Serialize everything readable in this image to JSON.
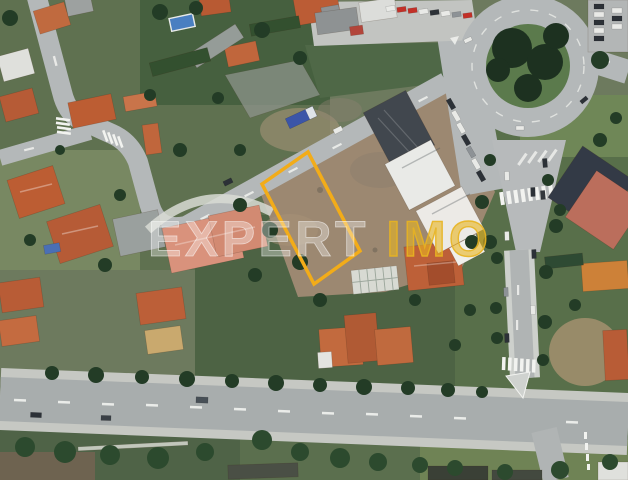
{
  "watermark": {
    "text": "EXPERTIMO",
    "text_primary": "EXPERT",
    "text_accent": "IMO",
    "primary_color": "#ffffff",
    "accent_color": "#e8b421"
  },
  "plot_highlight": {
    "points": "308,152 360,251 314,284 262,184",
    "stroke_color": "#f2ac19",
    "stroke_width": "3.5"
  },
  "palette": {
    "road": "#b4b8b9",
    "avenue_asphalt": "#a8adad",
    "sidewalk": "#c6c8c3",
    "dirt_lot": "#9c8871",
    "grass_dark": "#4d6344",
    "grass_mid": "#5f7150",
    "grass_light": "#72865a",
    "tree_dark": "#233c26",
    "roof_orange": "#c0653c",
    "roof_salmon": "#d9927c",
    "roof_dark_navy": "#333a46",
    "building_white": "#e9eae7",
    "building_dark": "#41474e",
    "marking_white": "#f2f3f0",
    "pool_blue": "#4a7fc1",
    "truck_blue": "#3b55a8"
  }
}
